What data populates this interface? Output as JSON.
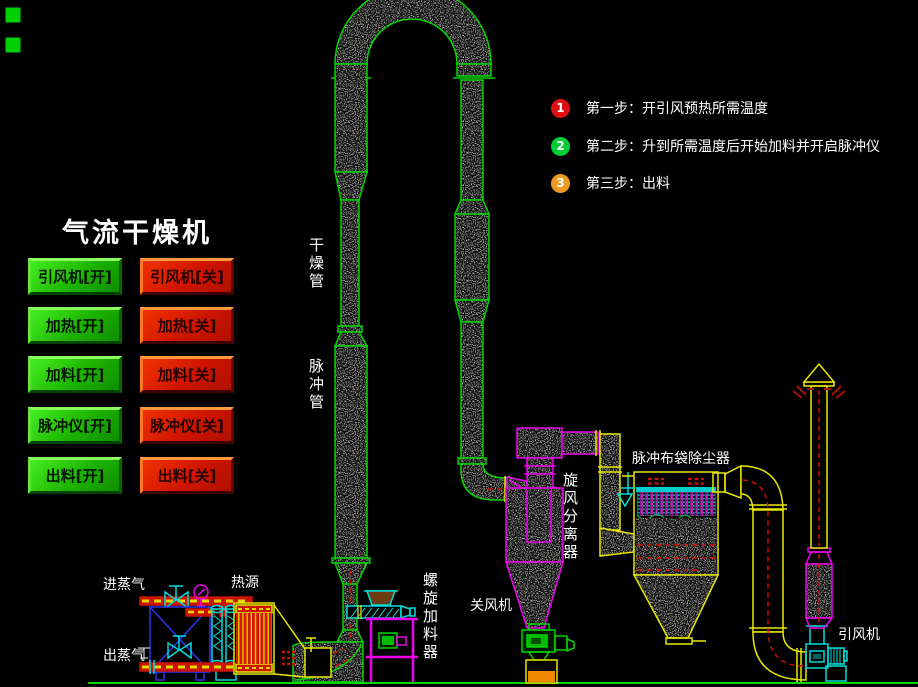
{
  "title": "气流干燥机",
  "indicators": {
    "color": "#00d000",
    "count": 2
  },
  "buttons": {
    "on": [
      {
        "label": "引风机[开]"
      },
      {
        "label": "加热[开]"
      },
      {
        "label": "加料[开]"
      },
      {
        "label": "脉冲仪[开]"
      },
      {
        "label": "出料[开]"
      }
    ],
    "off": [
      {
        "label": "引风机[关]"
      },
      {
        "label": "加热[关]"
      },
      {
        "label": "加料[关]"
      },
      {
        "label": "脉冲仪[关]"
      },
      {
        "label": "出料[关]"
      }
    ]
  },
  "steps": [
    {
      "num": "1",
      "color": "#dd1111",
      "text": "第一步：开引风预热所需温度"
    },
    {
      "num": "2",
      "color": "#00cc33",
      "text": "第二步：升到所需温度后开始加料并开启脉冲仪"
    },
    {
      "num": "3",
      "color": "#ee9922",
      "text": "第三步：出料"
    }
  ],
  "labels": {
    "drying_tube": "干燥管",
    "pulse_tube": "脉冲管",
    "screw_feeder": "螺旋加料器",
    "air_valve": "关风机",
    "cyclone": "旋风分离器",
    "dust_collector": "脉冲布袋除尘器",
    "draft_fan": "引风机",
    "steam_in": "进蒸气",
    "steam_out": "出蒸气",
    "heat_source": "热源"
  },
  "colors": {
    "background": "#000000",
    "button_on": "#1db300",
    "button_off": "#cf1400",
    "pipe_green": "#00d400",
    "cyclone_magenta": "#ee00ee",
    "duct_yellow": "#e8e800",
    "equipment_cyan": "#00dede",
    "flow_red": "#cc1100",
    "tank_blue": "#2b35ee"
  }
}
